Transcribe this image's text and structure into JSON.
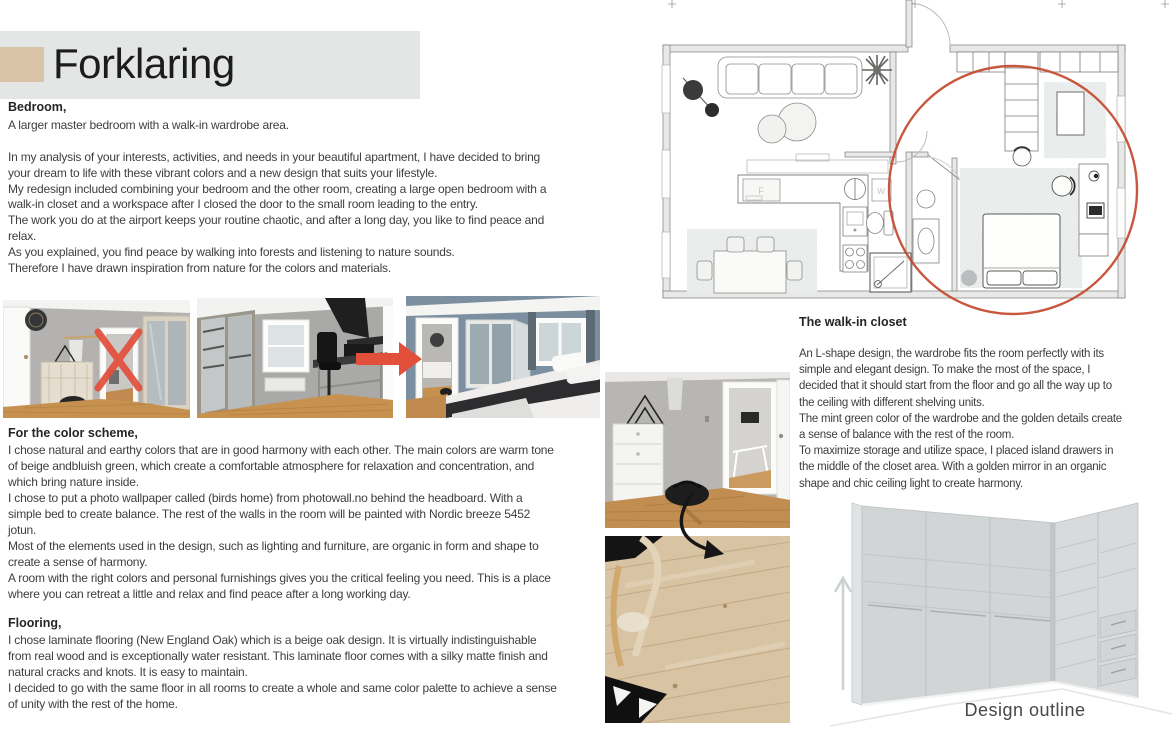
{
  "header": {
    "title": "Forklaring",
    "accent_color": "#d9c3a7",
    "banner_color": "#e3e6e4"
  },
  "sections": {
    "bedroom": {
      "heading": "Bedroom,",
      "subheading": "A larger master bedroom with a walk-in wardrobe area.",
      "body": "In my analysis of your interests, activities, and needs in your beautiful apartment, I have decided to bring\nyour dream to life with these vibrant colors and a new design that suits your lifestyle.\nMy redesign included combining your bedroom and the other room, creating a large open bedroom with a\nwalk-in closet and a workspace after I closed the door to the small room leading to the entry.\nThe work you do at the airport keeps your routine chaotic, and after a long day, you like to find peace and\nrelax.\nAs you explained, you find peace by walking into forests and listening to nature sounds.\nTherefore I have drawn inspiration from nature for the colors and materials."
    },
    "color_scheme": {
      "heading": "For the color scheme,",
      "body": "I chose natural and earthy colors that are in good harmony with each other. The main colors are warm tone\nof beige andbluish green, which create a comfortable atmosphere for relaxation and concentration, and\nwhich bring nature inside.\nI chose to put a photo wallpaper called (birds home) from photowall.no behind the headboard. With a\nsimple bed to create balance. The rest of the walls in the room will be painted with Nordic breeze 5452\njotun.\nMost of the elements used in the design, such as lighting and furniture, are organic in form and shape to\ncreate a sense of harmony.\nA room with the right colors and personal furnishings gives you the critical feeling you need. This is a place\nwhere you can retreat a little and relax and find peace after a long working day."
    },
    "flooring": {
      "heading": "Flooring,",
      "body": "I chose laminate flooring (New England Oak) which is a beige oak design. It is virtually indistinguishable\nfrom real wood and is exceptionally water resistant. This laminate floor comes with a silky matte finish and\nnatural cracks and knots. It is easy to maintain.\nI decided to go with the same floor in all rooms to create a whole and same color palette to achieve a sense\nof unity with the rest of the home."
    },
    "walk_in_closet": {
      "heading": "The walk-in closet",
      "body": "An L-shape design, the wardrobe fits the room perfectly with its\nsimple and elegant design. To make the most of the space, I\ndecided that it should start from the floor and go all the way up to\nthe ceiling with different shelving units.\nThe mint green color of the wardrobe and the golden details create\na sense of balance with the rest of the room.\nTo maximize storage and utilize space, I placed island drawers in\nthe middle of the closet area. With a golden mirror in an organic\nshape and chic ceiling light to create harmony."
    }
  },
  "floor_plan": {
    "fridge_label": "F",
    "washer_label": "W",
    "highlight_color": "#c4492e"
  },
  "design_outline": {
    "caption": "Design outline"
  },
  "annotations": {
    "reject_color": "#e2503c"
  }
}
